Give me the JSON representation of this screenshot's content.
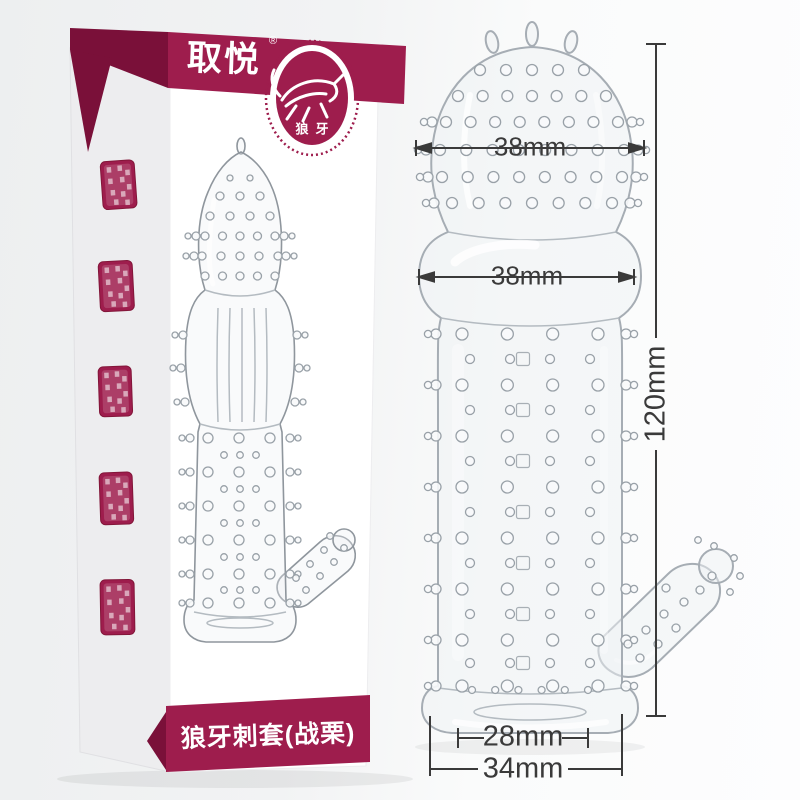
{
  "box": {
    "brand_logo": "取悦",
    "trademark": "®",
    "badge_label": "狼牙",
    "badge_icon": "wolf-icon",
    "product_name": "狼牙刺套(战栗)",
    "stamp_count": 5
  },
  "dimensions": {
    "head_width": "38mm",
    "bulb_width": "38mm",
    "length": "120mm",
    "opening_width": "28mm",
    "base_width": "34mm"
  },
  "colors": {
    "banner": "#9e1d4d",
    "banner_dark": "#7a1039",
    "dimension": "#3a3a3a"
  }
}
